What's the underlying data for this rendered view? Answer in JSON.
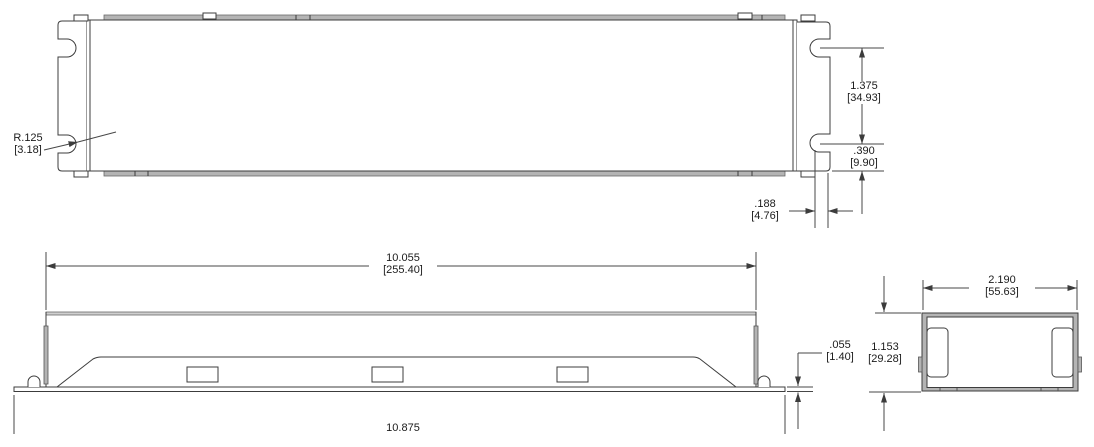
{
  "drawing": {
    "type": "engineering-dimension-drawing",
    "units": "inches [mm]",
    "views": {
      "top_view": "enclosure plan view with end mounting brackets and keyhole slots",
      "side_view": "enclosure side elevation with base plate and knockout openings",
      "end_view": "enclosure end cross-section"
    },
    "colors": {
      "background": "#ffffff",
      "part_line": "#3c3c3c",
      "dimension_line": "#474747",
      "section_fill": "#b4b4b4",
      "text": "#1b1b1b"
    }
  },
  "labels": {
    "slot_radius": {
      "in": "R.125",
      "mm": "[3.18]"
    },
    "slot_spacing": {
      "in": "1.375",
      "mm": "[34.93]"
    },
    "slot_to_edge": {
      "in": ".390",
      "mm": "[9.90]"
    },
    "slot_width": {
      "in": ".188",
      "mm": "[4.76]"
    },
    "body_length": {
      "in": "10.055",
      "mm": "[255.40]"
    },
    "base_thickness": {
      "in": ".055",
      "mm": "[1.40]"
    },
    "body_height": {
      "in": "1.153",
      "mm": "[29.28]"
    },
    "body_width": {
      "in": "2.190",
      "mm": "[55.63]"
    },
    "overall_length": {
      "in": "10.875"
    }
  }
}
